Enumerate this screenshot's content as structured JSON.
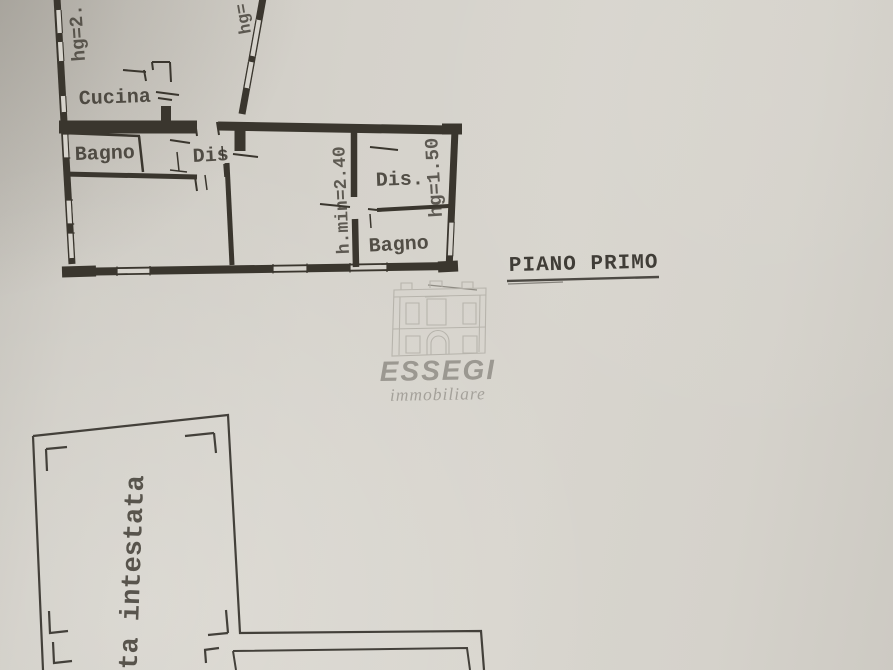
{
  "colors": {
    "paper": "#d6d3cc",
    "ink": "#3a362e",
    "faint_ink": "#8f8c84",
    "watermark_gray": "#8c8982",
    "letterhead_ink": "#43403a"
  },
  "floor_title": {
    "text": "PIANO PRIMO"
  },
  "upper_plan": {
    "room_labels": {
      "cucina": "Cucina",
      "bagno_left": "Bagno",
      "dis_left": "Dis",
      "dis_right": "Dis.",
      "bagno_right": "Bagno"
    },
    "height_labels": {
      "left": "hg=2..",
      "top": "hg=",
      "middle": "h.min=2.40",
      "right": "hg=1.50"
    }
  },
  "watermark": {
    "name": "ESSEGI",
    "tagline": "immobiliare"
  },
  "lower_plan": {
    "vertical_text": "tta intestata"
  }
}
